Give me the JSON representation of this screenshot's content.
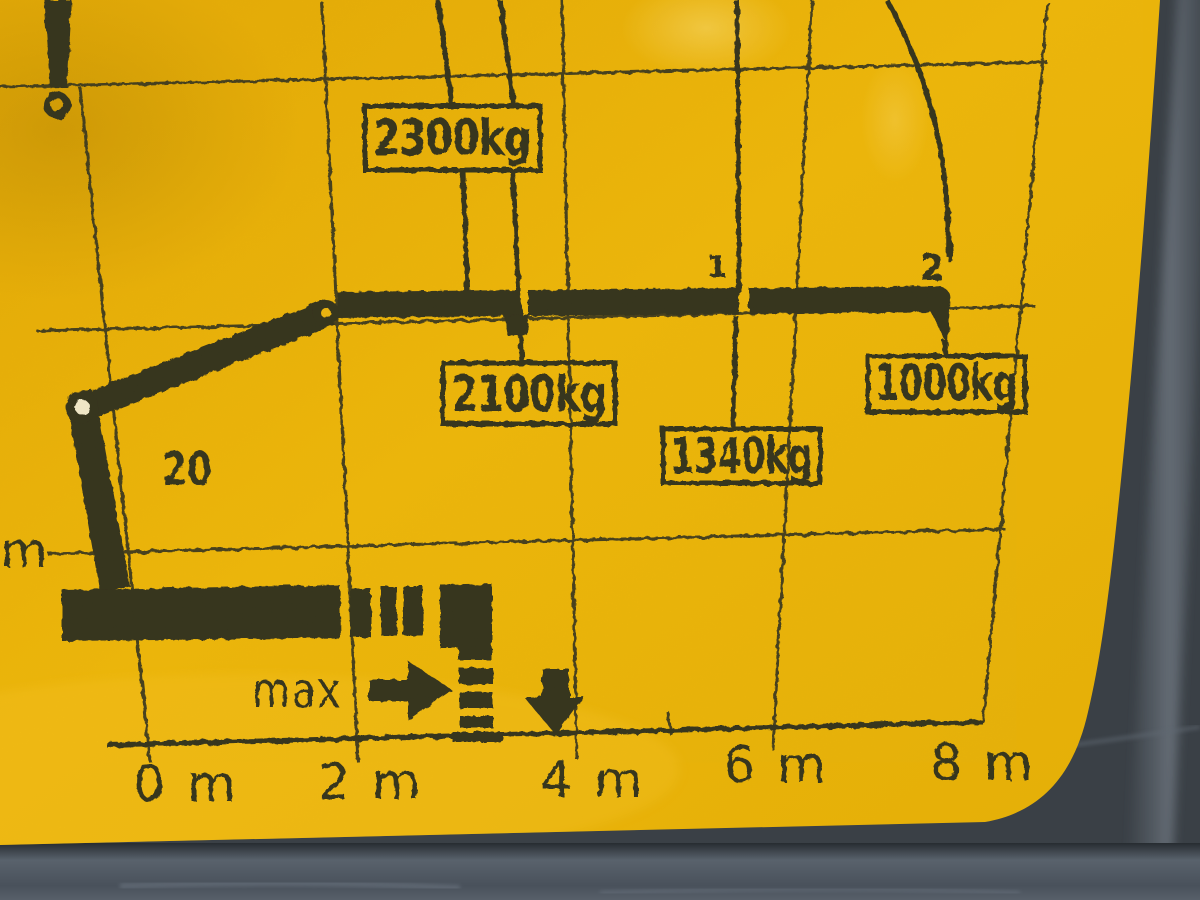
{
  "sticker": {
    "bg_color": "#f0b607",
    "ink_color": "#32301f",
    "surround_color": "#3a4046"
  },
  "diagram": {
    "load_labels": [
      {
        "text": "2300kg"
      },
      {
        "text": "2100kg"
      },
      {
        "text": "1340kg"
      },
      {
        "text": "1000kg"
      }
    ],
    "extension_marks": [
      {
        "text": "1"
      },
      {
        "text": "2"
      }
    ],
    "boom_label": "20",
    "max_label": "max",
    "x_axis_ticks": [
      {
        "text": "0 m"
      },
      {
        "text": "2 m"
      },
      {
        "text": "4 m"
      },
      {
        "text": "6 m"
      },
      {
        "text": "8 m"
      }
    ],
    "y_axis_ticks": [
      {
        "text": "m"
      },
      {
        "text": "m"
      }
    ]
  }
}
